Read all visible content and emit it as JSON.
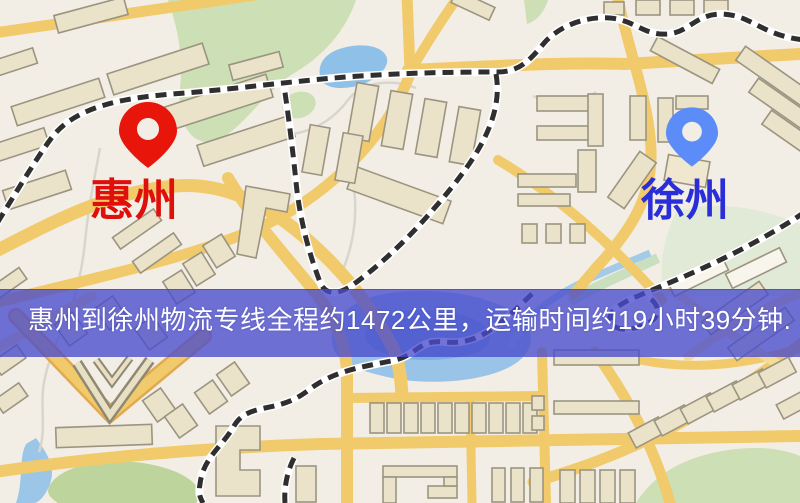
{
  "markers": {
    "origin": {
      "label": "惠州",
      "pin_color": "#e8150b",
      "label_color": "#df100b"
    },
    "destination": {
      "label": "徐州",
      "pin_color": "#5b8cf7",
      "label_color": "#2a2ed8"
    }
  },
  "banner": {
    "text": "惠州到徐州物流专线全程约1472公里，运输时间约19小时39分钟.",
    "background_color": "#4b4ecd",
    "text_color": "#ffffff"
  },
  "route": {
    "distance_text": "约1472公里",
    "duration_text": "约19小时39分钟"
  },
  "map_colors": {
    "background": "#f2eee5",
    "road": "#f1ca6b",
    "building": "#eae2c9",
    "building_outline": "#9b9480",
    "water": "#8fc0e8",
    "park": "#cddfb4",
    "railway": "#2f2f2f"
  }
}
